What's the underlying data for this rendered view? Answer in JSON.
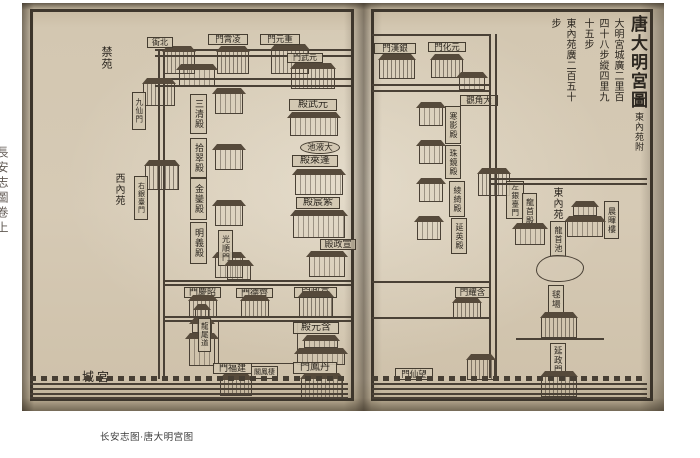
{
  "caption": "长安志图·唐大明宫图",
  "spine_text": "長安志圖卷上",
  "right_page": {
    "header": {
      "title": "唐大明宮圖",
      "subtitle": "東內苑附",
      "note1": "大明宮城廣二里百四十八步縱四里九十五步",
      "note2": "東內苑廣二百五十步"
    },
    "labels": {
      "yinhan_gate": "門漢銀",
      "yuanhua_gate": "門化元",
      "dajiao_abbey": "觀角大",
      "hanying_hall": "寒影殿",
      "zhujing_hall": "珠鏡殿",
      "lingqi_hall": "綾綺殿",
      "yanying_hall": "延英殿",
      "zuoyintai_gate": "左銀臺門",
      "hanyao_gate": "門耀含",
      "wangxian_gate": "門仙望",
      "dong_nei_yuan": "東內苑",
      "longshou_hall": "龍首殿",
      "chenhui_tower": "晨暉樓",
      "longshou_pool": "龍首池",
      "qiu_chang": "毬場",
      "yanzheng_gate": "延政門"
    }
  },
  "left_page": {
    "areas": {
      "jin_yuan": "禁苑",
      "xi_nei_yuan": "西內苑",
      "gong_cheng": "城宮"
    },
    "labels": {
      "bei_ya": "衙北",
      "lingxiao_gate": "門霄凌",
      "chongyuan_gate": "門元重",
      "yuanwu_gate": "門武元",
      "jiuxian_gate": "九仙門",
      "youyintai_gate": "右銀臺門",
      "yuanwu_hall": "殿武元",
      "sanqing_hall": "三清殿",
      "shicui_hall": "拾翠殿",
      "jinluan_hall": "金鑾殿",
      "mingyi_hall": "明義殿",
      "taiye_pool": "池液大",
      "penglai_hall": "殿萊蓬",
      "zichen_hall": "殿宸紫",
      "xuanzheng_hall": "殿政宣",
      "guangshun_gate": "光順門",
      "zhaoqing_gate": "門慶昭",
      "qide_gate": "門德齊",
      "xuanzheng_gate": "門政宣",
      "longwei_ramp": "龍尾道",
      "hanyuan_hall": "殿元含",
      "danfeng_gate": "門鳳丹",
      "jianfu_gate": "門福建",
      "qifeng_pavilion": "閣鳳棲"
    }
  }
}
